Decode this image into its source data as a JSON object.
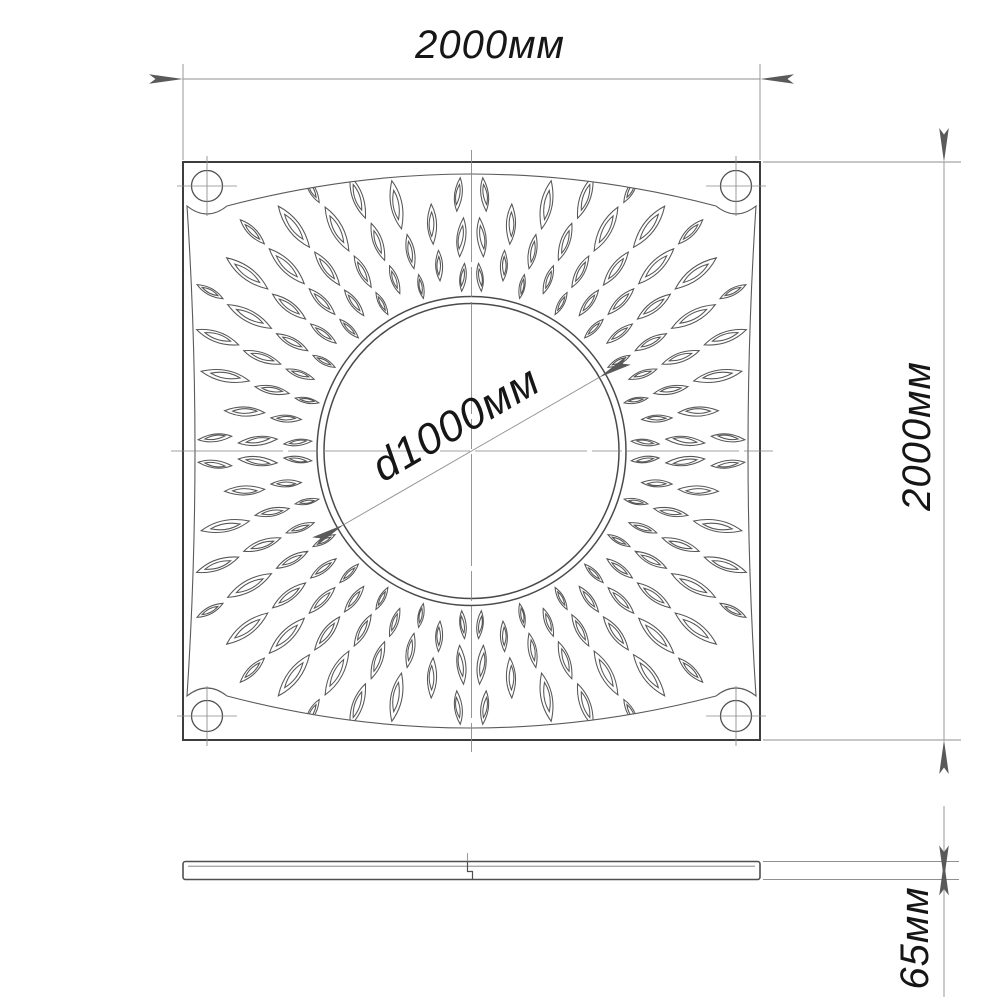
{
  "labels": {
    "width": "2000мм",
    "height": "2000мм",
    "diameter": "d1000мм",
    "thickness": "65мм"
  },
  "colors": {
    "outline": "#3d3d3d",
    "pattern_line": "#565656",
    "thin_line": "#8f8f8f",
    "arrow": "#5a5a5a",
    "text": "#161616",
    "background": "#ffffff"
  }
}
